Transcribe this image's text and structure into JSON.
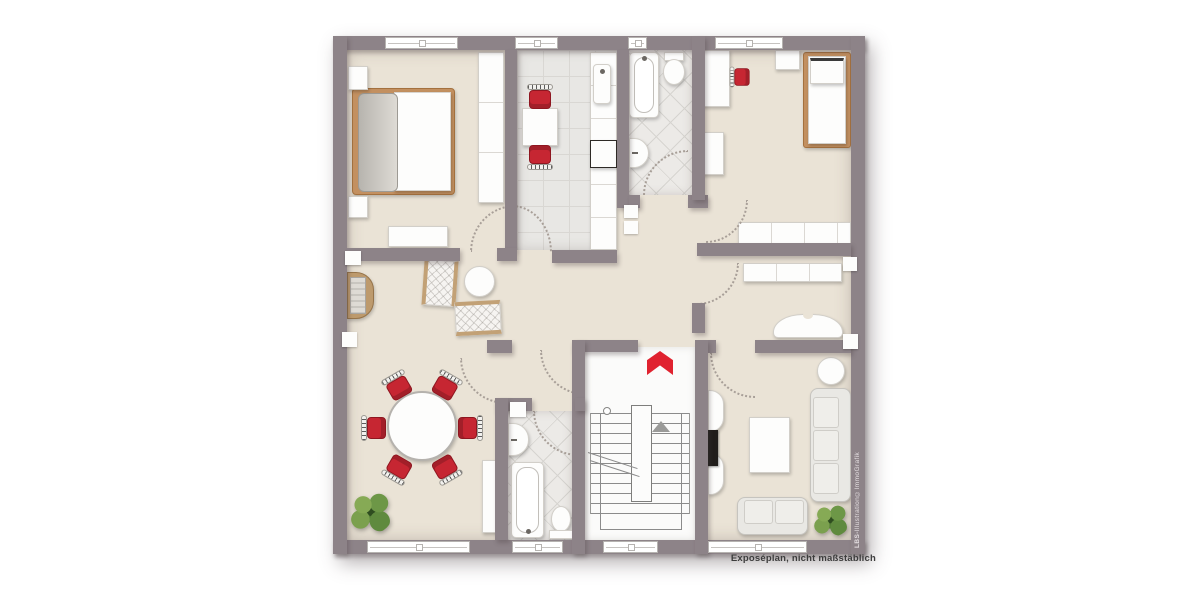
{
  "footer": {
    "caption": "Exposéplan, nicht maßstäblich"
  },
  "watermark": {
    "brand": "LBS-",
    "text": "Illustration©ImmoGrafik"
  },
  "colors": {
    "wall": "#8d8388",
    "floor_beige": "#eae3d6",
    "tile_light": "#e8e7e4",
    "stair_floor": "#fbfbfa",
    "accent_red": "#c62632",
    "entrance_arrow_red": "#e0222f",
    "wood_tan": "#c39060",
    "plant_green": "#5f8a3e"
  }
}
